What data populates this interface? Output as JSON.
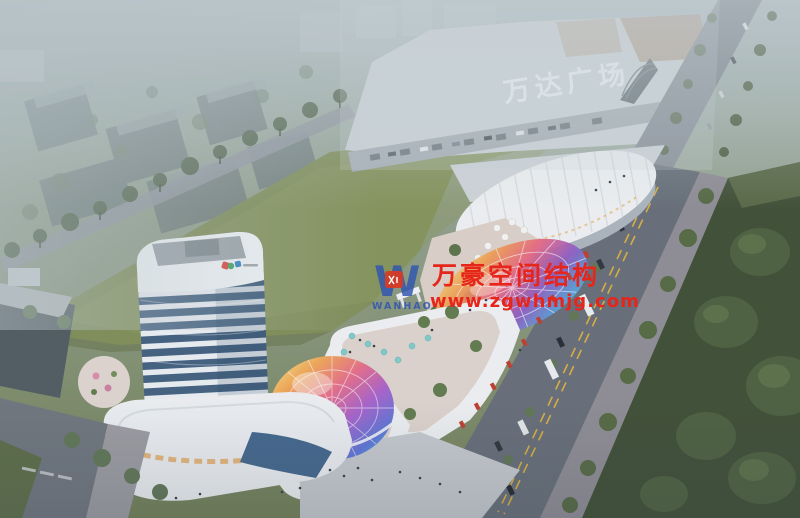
{
  "scene": {
    "description": "Aerial dusk architectural rendering: mixed-use complex with a white balcony tower, curved retail strip, rainbow glass canopies, large lawn, and Wanda Plaza mall across the road",
    "signs": {
      "mall_roof_sign": "万达广场"
    },
    "watermark": {
      "monogram": "W",
      "logo_text": "WANHAO",
      "brand": "万豪空间结构",
      "url": "www.zgwhmjg.com",
      "brand_color": "#e6261b",
      "logo_blue": "#2f55b0",
      "badge_red": "#d93a22"
    },
    "palette": {
      "lawn": "#7e8c55",
      "haze": "#b9c4c8",
      "road": "#6a717b",
      "dark_grass": "#3c4b31",
      "tower_glass": "#3f5d7d",
      "white_building": "#eef0f2",
      "terrace": "#dccfc8",
      "lane_marking": "#d9ae3c",
      "awning_red": "#bf3a2a",
      "umbrella_teal": "#7fc9c9"
    }
  }
}
